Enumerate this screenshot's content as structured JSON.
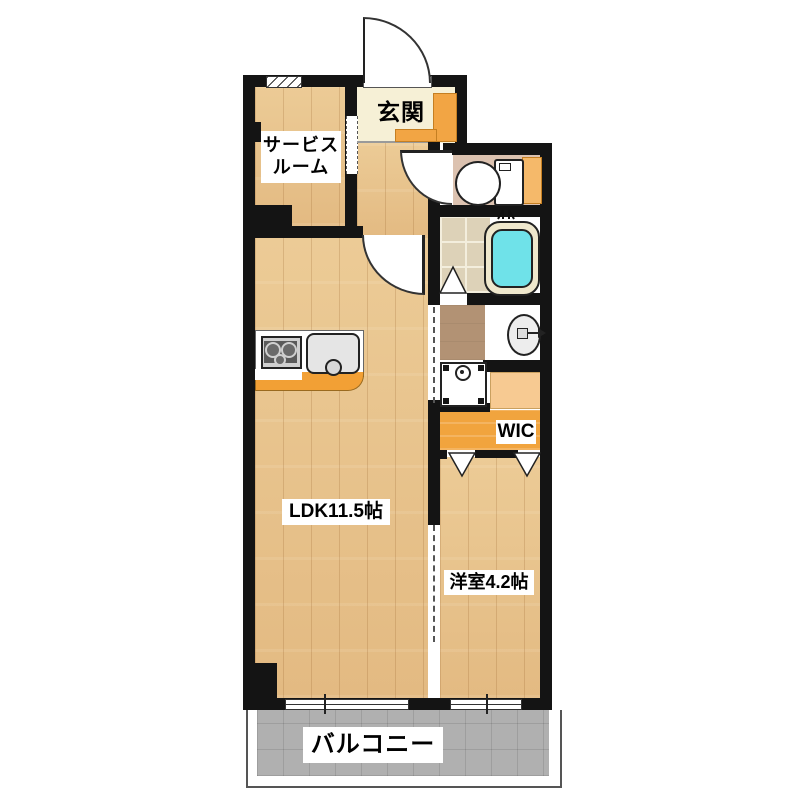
{
  "floorplan": {
    "rooms": {
      "entrance": {
        "label": "玄関"
      },
      "service_room": {
        "label_line1": "サービス",
        "label_line2": "ルーム"
      },
      "ldk": {
        "label": "LDK11.5帖"
      },
      "western_room": {
        "label": "洋室4.2帖"
      },
      "wic": {
        "label": "WIC"
      },
      "balcony": {
        "label": "バルコニー"
      }
    },
    "palette": {
      "wall": "#141414",
      "wood_floor": "#e9c48e",
      "entrance_floor": "#f6f0d6",
      "toilet_floor": "#dcc2b0",
      "bath_tile": "#ddd2b8",
      "bathtub_water": "#6fe2e9",
      "washroom_floor": "#b29274",
      "wic_floor": "#f1a43e",
      "cabinet_orange": "#f2a544",
      "balcony_floor": "#b0b0b0"
    }
  }
}
